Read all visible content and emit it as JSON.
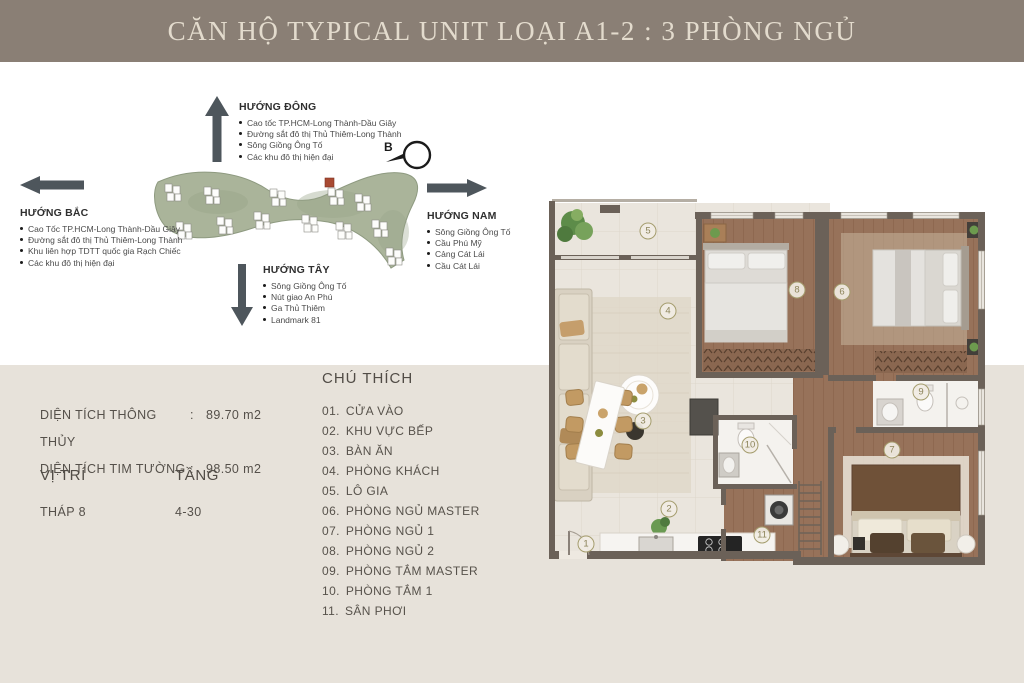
{
  "banner": {
    "title": "CĂN HỘ TYPICAL UNIT LOẠI A1-2 : 3 PHÒNG NGỦ"
  },
  "directions": {
    "east": {
      "label": "HƯỚNG ĐÔNG",
      "items": [
        "Cao tốc TP.HCM-Long Thành-Dầu Giây",
        "Đường sắt đô thị Thủ Thiêm-Long Thành",
        "Sông Giồng Ông Tố",
        "Các khu đô thị hiện đại"
      ]
    },
    "north": {
      "label": "HƯỚNG BẮC",
      "items": [
        "Cao Tốc TP.HCM-Long Thành-Dầu Giây",
        "Đường sắt đô thị Thủ Thiêm-Long Thành",
        "Khu liên hợp TDTT quốc gia Rạch Chiếc",
        "Các khu đô thị hiện đại"
      ]
    },
    "south": {
      "label": "HƯỚNG NAM",
      "items": [
        "Sông Giồng Ông Tố",
        "Cầu Phú Mỹ",
        "Cảng Cát Lái",
        "Cầu Cát Lái"
      ]
    },
    "west": {
      "label": "HƯỚNG TÂY",
      "items": [
        "Sông Giồng Ông Tố",
        "Nút giao An Phú",
        "Ga Thủ Thiêm",
        "Landmark 81"
      ]
    }
  },
  "compass": {
    "north_label": "B"
  },
  "info": {
    "area_rows": [
      {
        "label": "DIỆN TÍCH THÔNG THỦY",
        "sep": ":",
        "value": "89.70 m2"
      },
      {
        "label": "DIỆN TÍCH TIM TƯỜNG",
        "sep": ":",
        "value": "98.50 m2"
      }
    ],
    "position_label": "VỊ TRÍ",
    "floor_label": "TẦNG",
    "position_value": "THÁP 8",
    "floor_value": "4-30"
  },
  "legend": {
    "title": "CHÚ THÍCH",
    "items": [
      {
        "num": "01.",
        "label": "CỬA VÀO"
      },
      {
        "num": "02.",
        "label": "KHU VỰC BẾP"
      },
      {
        "num": "03.",
        "label": "BÀN ĂN"
      },
      {
        "num": "04.",
        "label": "PHÒNG KHÁCH"
      },
      {
        "num": "05.",
        "label": "LÔ GIA"
      },
      {
        "num": "06.",
        "label": "PHÒNG NGỦ MASTER"
      },
      {
        "num": "07.",
        "label": "PHÒNG NGỦ 1"
      },
      {
        "num": "08.",
        "label": "PHÒNG NGỦ 2"
      },
      {
        "num": "09.",
        "label": "PHÒNG TẮM MASTER"
      },
      {
        "num": "10.",
        "label": "PHÒNG TẮM 1"
      },
      {
        "num": "11.",
        "label": "SÂN PHƠI"
      }
    ]
  },
  "floorplan": {
    "badges": [
      {
        "num": "1",
        "x": 43,
        "y": 351
      },
      {
        "num": "2",
        "x": 126,
        "y": 316
      },
      {
        "num": "3",
        "x": 100,
        "y": 228
      },
      {
        "num": "4",
        "x": 125,
        "y": 118
      },
      {
        "num": "5",
        "x": 105,
        "y": 38
      },
      {
        "num": "6",
        "x": 299,
        "y": 99
      },
      {
        "num": "7",
        "x": 349,
        "y": 257
      },
      {
        "num": "8",
        "x": 254,
        "y": 97
      },
      {
        "num": "9",
        "x": 378,
        "y": 199
      },
      {
        "num": "10",
        "x": 207,
        "y": 252
      },
      {
        "num": "11",
        "x": 219,
        "y": 342
      }
    ]
  },
  "colors": {
    "banner_bg": "#8a7f75",
    "banner_fg": "#e3dbcd",
    "panel_bg": "#e7e2da",
    "wall": "#6b6158",
    "wood_floor": "#97725a",
    "tile_floor": "#eae5dd",
    "badge_ring": "#a59d6e",
    "arrow": "#4e565c",
    "sitemap_green": "#aab49a",
    "highlight_tower_red": "#a84a32"
  }
}
